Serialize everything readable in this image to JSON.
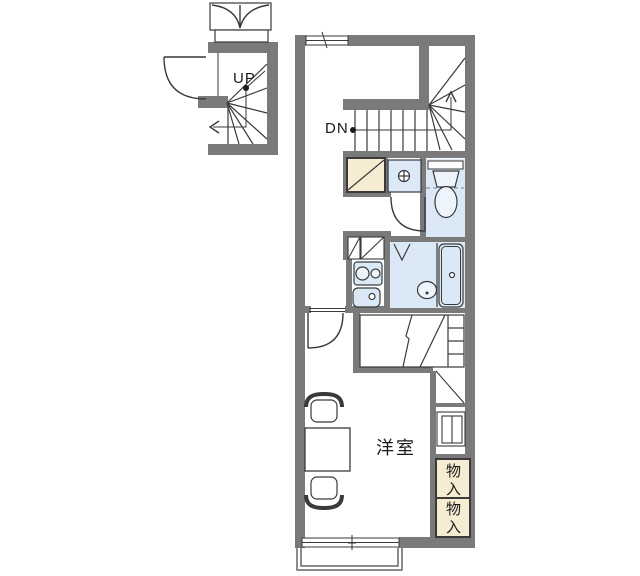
{
  "plan": {
    "kind": "apartment-floor-plan"
  },
  "labels": {
    "stairs_up": "UP",
    "stairs_down": "DN"
  },
  "rooms": {
    "western_room": "洋室"
  },
  "storage": {
    "closet_top": "物入",
    "closet_bottom": "物入"
  },
  "colors": {
    "wall": "#7a7a7a",
    "line": "#3a3a3a",
    "fixture_blue": "#dbe8f6",
    "fixture_blue_light": "#eef4fb",
    "cream": "#f6ecd2",
    "balcony_line": "#666666",
    "dash": "#8a98a8",
    "text": "#1a1a1a",
    "background": "#ffffff"
  }
}
